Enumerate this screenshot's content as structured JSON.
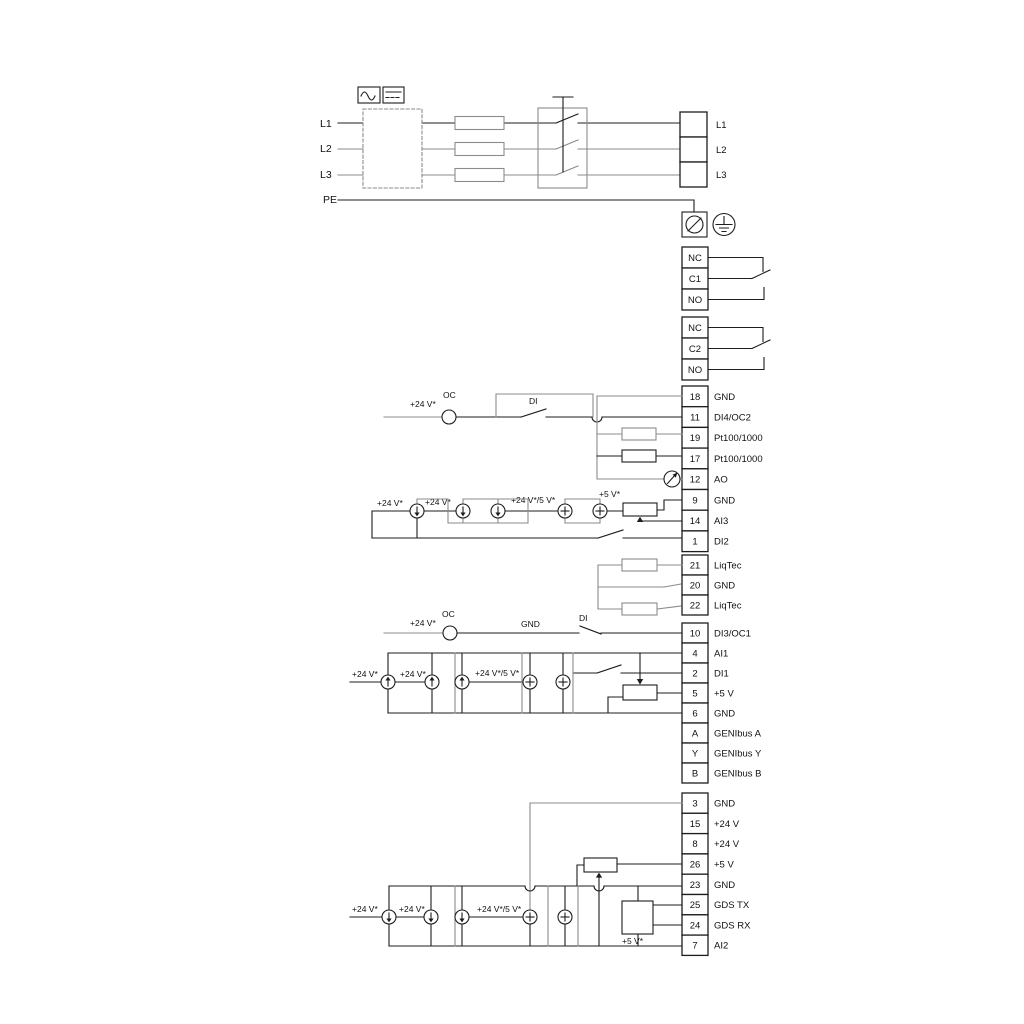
{
  "power": {
    "inputs": [
      "L1",
      "L2",
      "L3",
      "PE"
    ],
    "outputs": [
      "L1",
      "L2",
      "L3"
    ]
  },
  "relays": {
    "relay1": [
      "NC",
      "C1",
      "NO"
    ],
    "relay2": [
      "NC",
      "C2",
      "NO"
    ]
  },
  "io1": [
    {
      "num": "18",
      "label": "GND"
    },
    {
      "num": "11",
      "label": "DI4/OC2"
    },
    {
      "num": "19",
      "label": "Pt100/1000"
    },
    {
      "num": "17",
      "label": "Pt100/1000"
    },
    {
      "num": "12",
      "label": "AO"
    },
    {
      "num": "9",
      "label": "GND"
    },
    {
      "num": "14",
      "label": "AI3"
    },
    {
      "num": "1",
      "label": "DI2"
    }
  ],
  "io2": [
    {
      "num": "21",
      "label": "LiqTec"
    },
    {
      "num": "20",
      "label": "GND"
    },
    {
      "num": "22",
      "label": "LiqTec"
    }
  ],
  "io3": [
    {
      "num": "10",
      "label": "DI3/OC1"
    },
    {
      "num": "4",
      "label": "AI1"
    },
    {
      "num": "2",
      "label": "DI1"
    },
    {
      "num": "5",
      "label": "+5 V"
    },
    {
      "num": "6",
      "label": "GND"
    },
    {
      "num": "A",
      "label": "GENIbus A"
    },
    {
      "num": "Y",
      "label": "GENIbus Y"
    },
    {
      "num": "B",
      "label": "GENIbus B"
    }
  ],
  "io4": [
    {
      "num": "3",
      "label": "GND"
    },
    {
      "num": "15",
      "label": "+24 V"
    },
    {
      "num": "8",
      "label": "+24 V"
    },
    {
      "num": "26",
      "label": "+5 V"
    },
    {
      "num": "23",
      "label": "GND"
    },
    {
      "num": "25",
      "label": "GDS TX"
    },
    {
      "num": "24",
      "label": "GDS RX"
    },
    {
      "num": "7",
      "label": "AI2"
    }
  ],
  "labels": {
    "plus24": "+24 V*",
    "plus24_5": "+24 V*/5 V*",
    "plus5": "+5 V*",
    "oc": "OC",
    "di": "DI",
    "gnd": "GND"
  },
  "colors": {
    "wire_black": "#1d1d1d",
    "wire_gray": "#8b8b8b"
  }
}
